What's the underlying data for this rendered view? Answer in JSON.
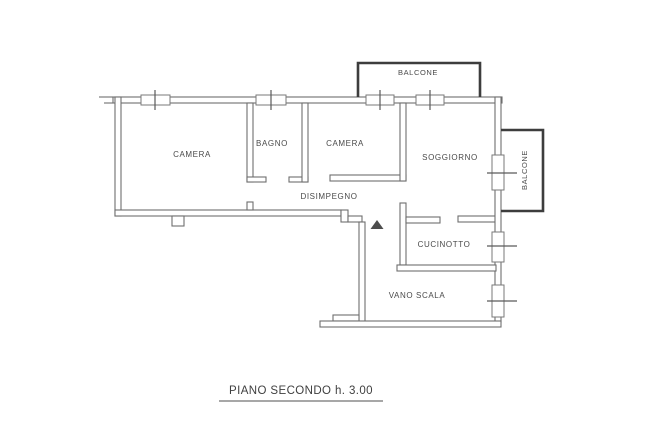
{
  "caption": {
    "text": "PIANO SECONDO h. 3.00"
  },
  "rooms": [
    {
      "id": "camera-1",
      "label": "CAMERA"
    },
    {
      "id": "bagno",
      "label": "BAGNO"
    },
    {
      "id": "camera-2",
      "label": "CAMERA"
    },
    {
      "id": "soggiorno",
      "label": "SOGGIORNO"
    },
    {
      "id": "disimpegno",
      "label": "DISIMPEGNO"
    },
    {
      "id": "cucinotto",
      "label": "CUCINOTTO"
    },
    {
      "id": "vano-scala",
      "label": "VANO SCALA"
    },
    {
      "id": "balcone-top",
      "label": "BALCONE"
    },
    {
      "id": "balcone-right",
      "label": "BALCONE"
    }
  ],
  "colors": {
    "wall": "#6e6e6e",
    "balcony_wall": "#3d3d3d",
    "text": "#4a4a4a",
    "door_marker": "#4d4d4d",
    "background": "#ffffff"
  }
}
